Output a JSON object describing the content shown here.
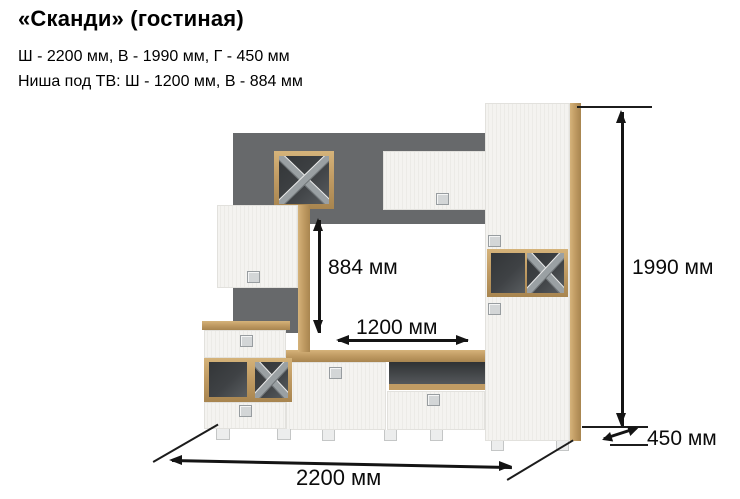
{
  "header": {
    "title": "«Сканди» (гостиная)",
    "spec_line1": "Ш - 2200 мм, В - 1990 мм, Г - 450 мм",
    "spec_line2": "Ниша под ТВ: Ш - 1200 мм, В - 884 мм"
  },
  "diagram": {
    "labels": {
      "niche_height": "884 мм",
      "niche_width": "1200 мм",
      "total_height": "1990 мм",
      "depth": "450 мм",
      "total_width": "2200 мм"
    }
  },
  "colors": {
    "wood": "#c19c64",
    "wood_dark": "#a8854f",
    "front_white": "#f4f3f0",
    "back_panel": "#67696b",
    "interior_dark": "#3f4245",
    "line_color": "#141414",
    "handle_fill": "#d3d6d7"
  }
}
